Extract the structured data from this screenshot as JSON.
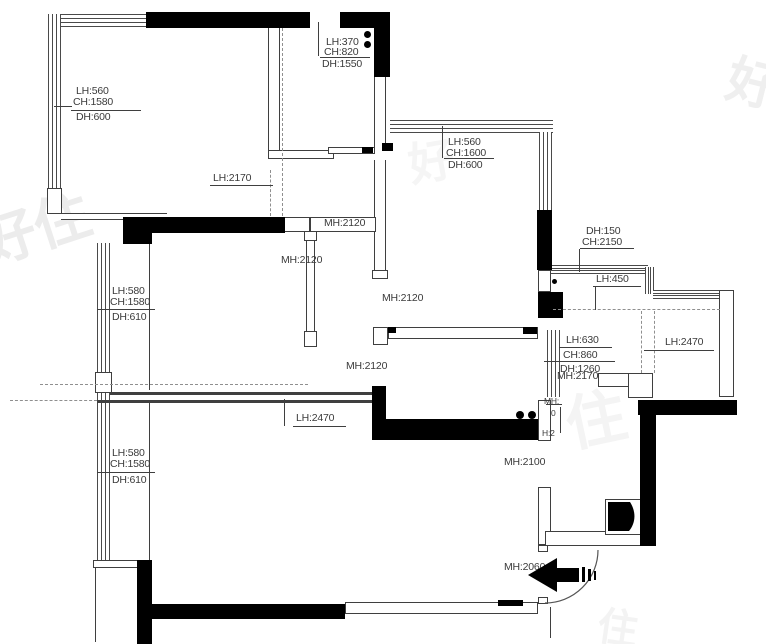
{
  "plan": {
    "type": "floor-plan",
    "units": "mm",
    "colors": {
      "wall": "#000000",
      "line": "#3f3f3f",
      "dashed": "#8f8f8f",
      "label": "#3b3b3b",
      "watermark": "#ececec"
    },
    "annotations": {
      "window_top_left": {
        "line1": "LH:560",
        "line2": "CH:1580",
        "line3": "DH:600"
      },
      "closet_window": {
        "line1": "LH:370",
        "line2": "CH:820",
        "line3": "DH:1550"
      },
      "sliding_door": {
        "text": "LH:2170"
      },
      "door_top": {
        "text": "MH:2120"
      },
      "door_living": {
        "text": "MH:2120"
      },
      "window_top_right": {
        "line1": "LH:560",
        "line2": "CH:1600",
        "line3": "DH:600"
      },
      "door_center": {
        "text": "MH:2120"
      },
      "bay_window": {
        "line1": "DH:150",
        "line2": "CH:2150"
      },
      "bay_sill": {
        "text": "LH:450"
      },
      "window_mid_left": {
        "line1": "LH:580",
        "line2": "CH:1580",
        "line3": "DH:610"
      },
      "door_hall": {
        "text": "MH:2120"
      },
      "glass_partition": {
        "line1": "LH:630",
        "line2": "CH:860",
        "line3": "DH:1260"
      },
      "beam_right": {
        "text": "LH:2470"
      },
      "door_right": {
        "text": "MH:2170"
      },
      "beam_left": {
        "text": "LH:2470"
      },
      "window_bottom_left": {
        "line1": "LH:580",
        "line2": "CH:1580",
        "line3": "DH:610"
      },
      "door_bath": {
        "text": "MH:2100"
      },
      "entry_door": {
        "text": "MH:2060"
      },
      "vertical_fragment": {
        "f1": "MH:",
        "f2": "0",
        "f3": "H:2"
      }
    },
    "watermarks": {
      "left": "好住",
      "right": "好",
      "center": "住",
      "upper": "好",
      "bottom": "住"
    }
  }
}
